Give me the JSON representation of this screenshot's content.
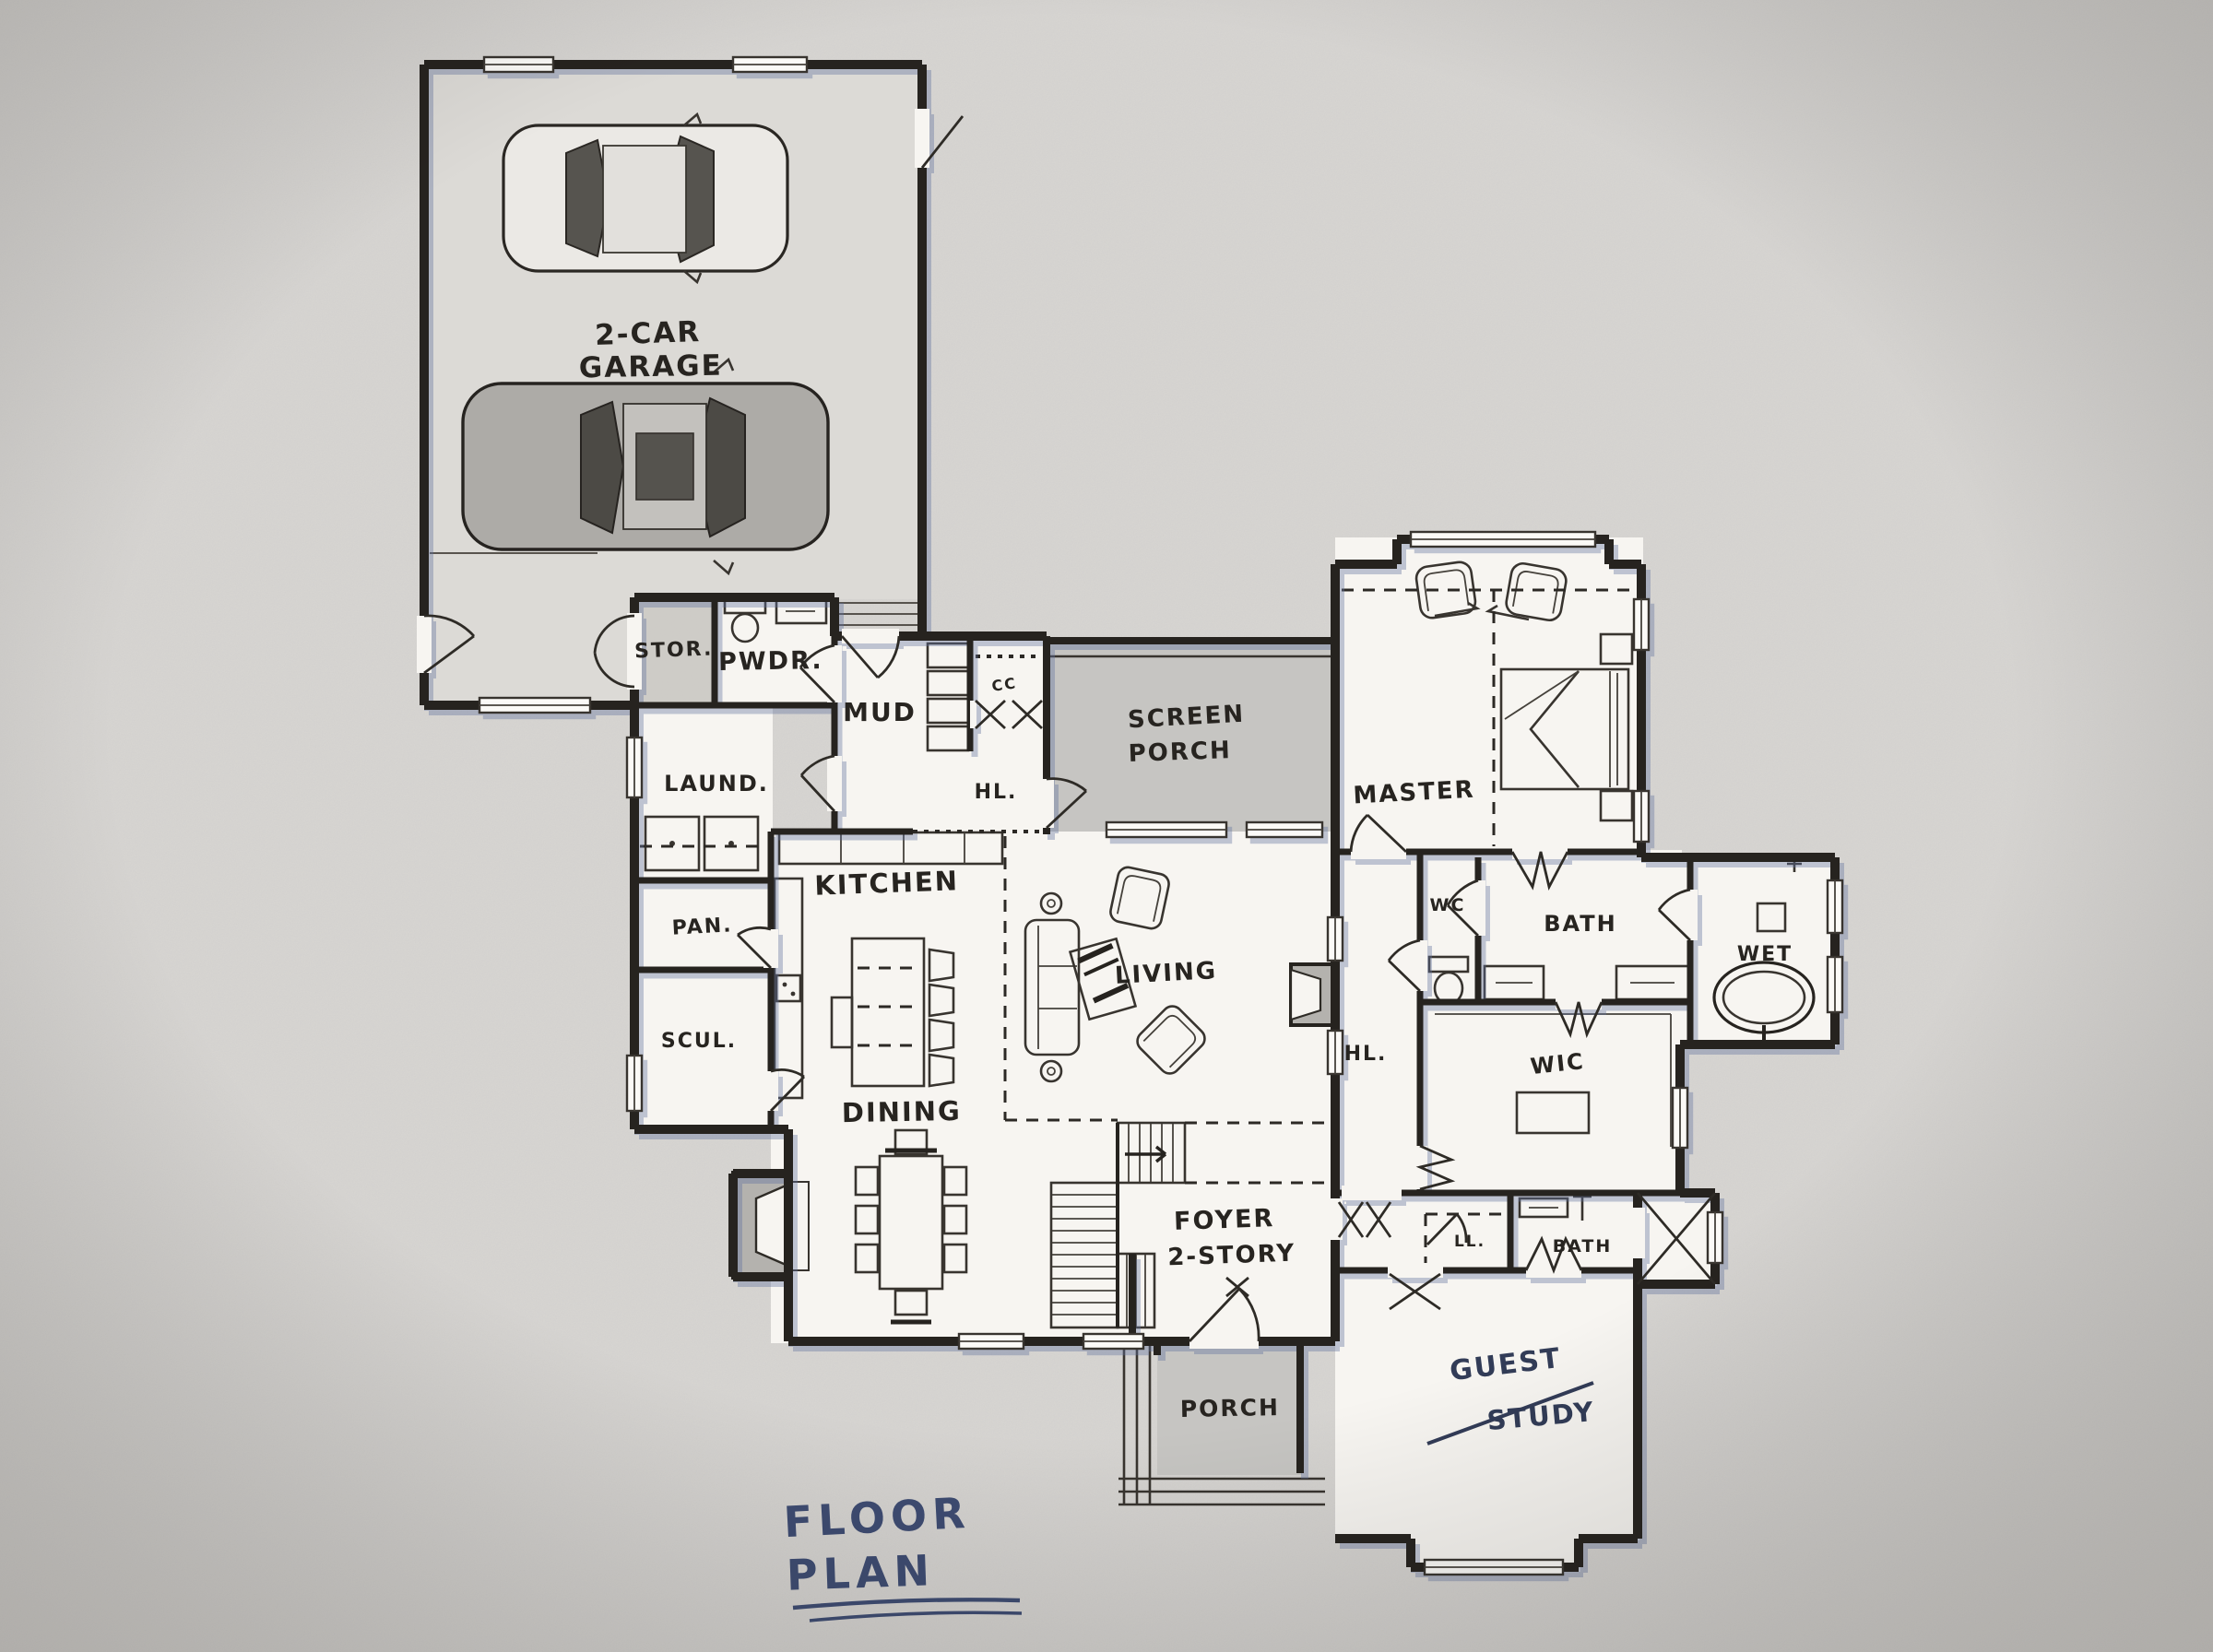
{
  "title": {
    "line1": "FLOOR",
    "line2": "PLAN"
  },
  "rooms": {
    "garage": {
      "line1": "2-CAR",
      "line2": "GARAGE"
    },
    "storage": "STOR.",
    "powder": "PWDR.",
    "mud": "MUD",
    "coat_closet": "CC",
    "hall_mud": "HL.",
    "laundry": "LAUND.",
    "kitchen": "KITCHEN",
    "pantry": "PAN.",
    "scullery": "SCUL.",
    "dining": "DINING",
    "screen_porch": {
      "line1": "SCREEN",
      "line2": "PORCH"
    },
    "living": "LIVING",
    "master": "MASTER",
    "wc": "WC",
    "master_bath": "BATH",
    "wet": "WET",
    "wic": "WIC",
    "hall_stairs": "HL.",
    "foyer": {
      "line1": "FOYER",
      "line2": "2-STORY"
    },
    "linen": "LL.",
    "guest_bath": "BATH",
    "porch": "PORCH",
    "guest": {
      "line1": "GUEST",
      "line2": "STUDY"
    }
  },
  "colors": {
    "paper": "#d6d4d1",
    "ink": "#26231f",
    "plan_fill": "#f7f5f1",
    "porch_fill": "#c9c7c4",
    "garage_fill": "#dcdad6",
    "title_ink": "#3e4c72"
  }
}
